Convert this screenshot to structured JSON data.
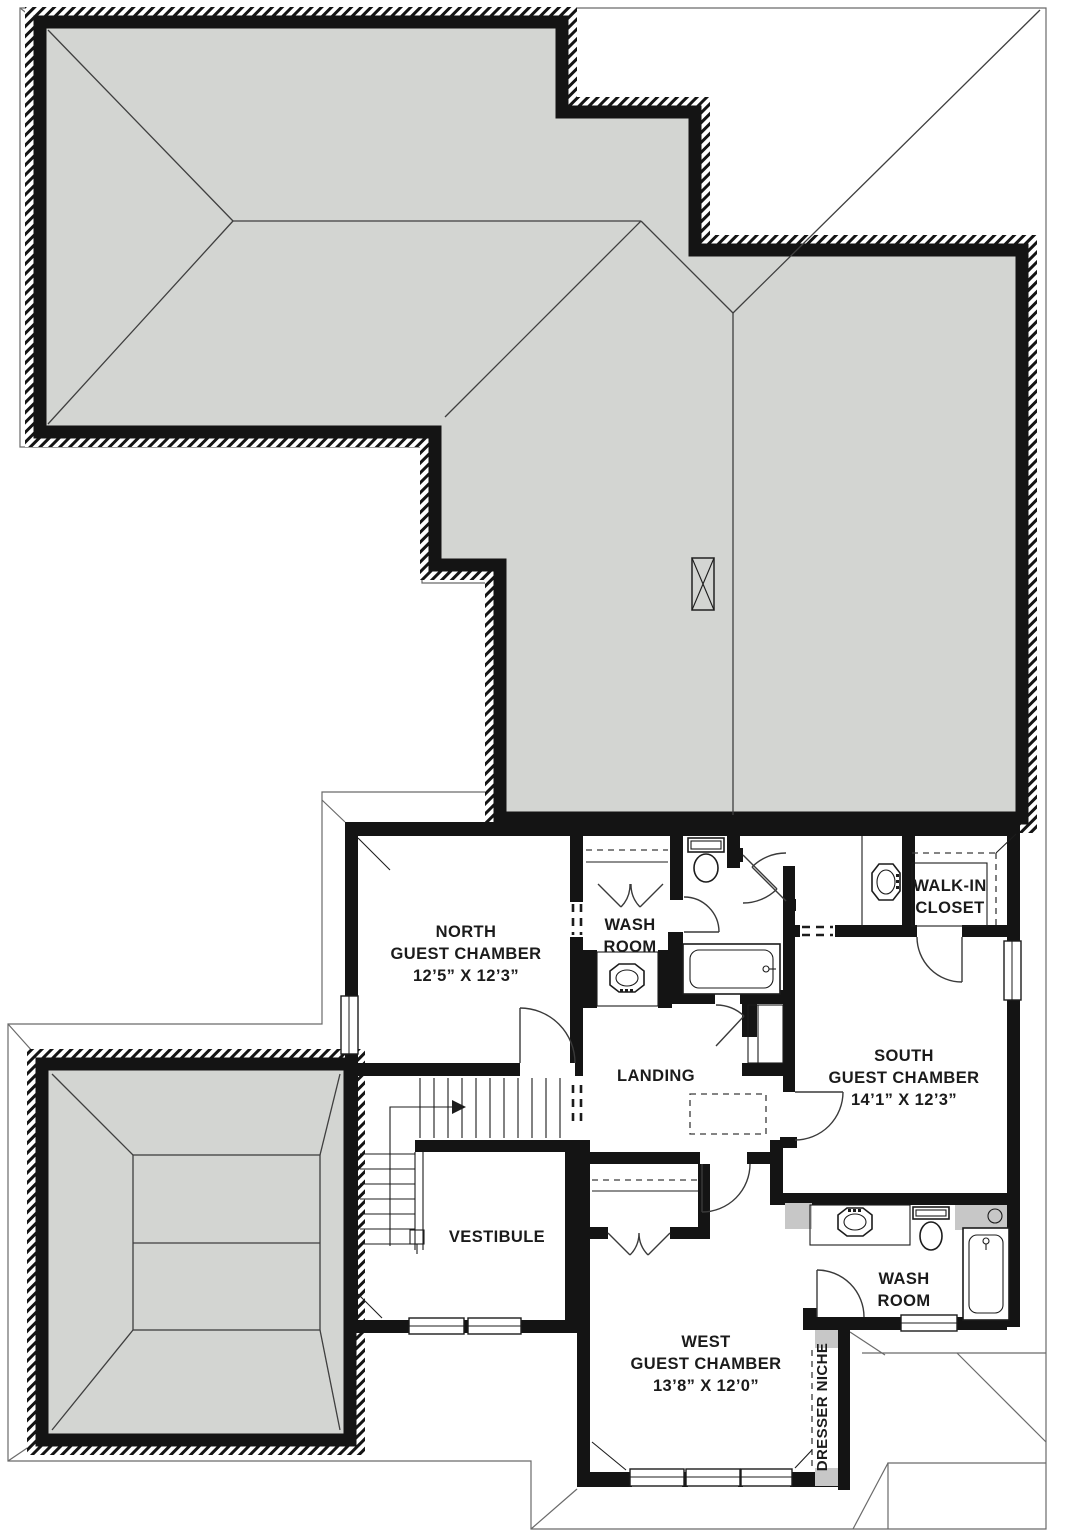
{
  "drawing": {
    "type": "second-floor-plan-with-roof",
    "colors": {
      "roof_fill": "#d3d5d2",
      "wall": "#141414",
      "tile_accent": "#c7c7c7",
      "background": "#ffffff"
    },
    "rooms": {
      "north_guest_chamber": {
        "line1": "NORTH",
        "line2": "GUEST CHAMBER",
        "dims": "12’5” X 12’3”"
      },
      "wash_room_north": {
        "line1": "WASH",
        "line2": "ROOM"
      },
      "walk_in_closet": {
        "line1": "WALK-IN",
        "line2": "CLOSET"
      },
      "landing": {
        "label": "LANDING"
      },
      "south_guest_chamber": {
        "line1": "SOUTH",
        "line2": "GUEST CHAMBER",
        "dims": "14’1” X 12’3”"
      },
      "vestibule": {
        "label": "VESTIBULE"
      },
      "west_guest_chamber": {
        "line1": "WEST",
        "line2": "GUEST CHAMBER",
        "dims": "13’8” X 12’0”"
      },
      "wash_room_south": {
        "line1": "WASH",
        "line2": "ROOM"
      },
      "dresser_niche": {
        "label": "DRESSER NICHE"
      }
    }
  }
}
